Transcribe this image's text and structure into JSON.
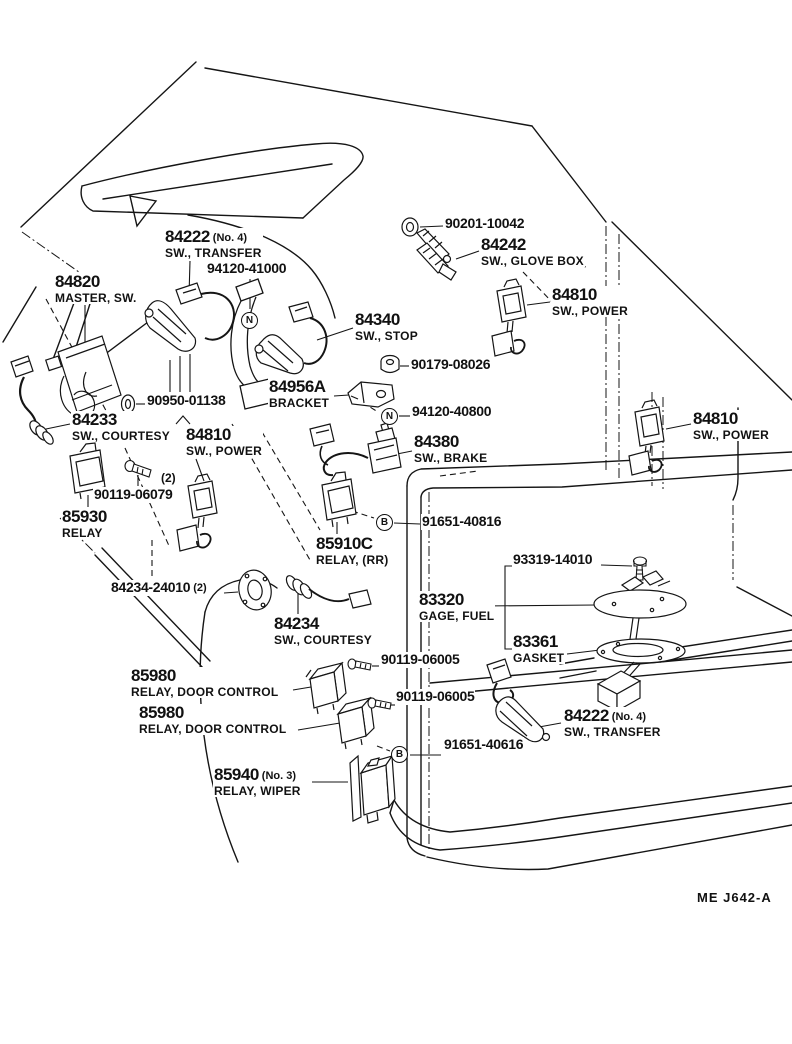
{
  "figure_code": "ME J642-A",
  "callouts": [
    {
      "num": "84222",
      "note": "(No. 4)",
      "desc": "SW., TRANSFER"
    },
    {
      "num": "94120-41000"
    },
    {
      "num": "90201-10042"
    },
    {
      "num": "84242",
      "desc": "SW., GLOVE BOX"
    },
    {
      "num": "84820",
      "desc": "MASTER, SW."
    },
    {
      "num": "84810",
      "desc": "SW., POWER"
    },
    {
      "num": "84340",
      "desc": "SW., STOP"
    },
    {
      "num": "90179-08026"
    },
    {
      "num": "84956A",
      "desc": "BRACKET"
    },
    {
      "num": "90950-01138"
    },
    {
      "num": "94120-40800"
    },
    {
      "num": "84233",
      "desc": "SW., COURTESY"
    },
    {
      "num": "84810",
      "desc": "SW., POWER"
    },
    {
      "num": "84810",
      "desc": "SW., POWER"
    },
    {
      "num": "84380",
      "desc": "SW., BRAKE"
    },
    {
      "note": "(2)"
    },
    {
      "num": "90119-06079"
    },
    {
      "num": "85930",
      "desc": "RELAY"
    },
    {
      "num": "91651-40816"
    },
    {
      "num": "85910C",
      "desc": "RELAY, (RR)"
    },
    {
      "num": "93319-14010"
    },
    {
      "num": "84234-24010",
      "note": "(2)"
    },
    {
      "num": "83320",
      "desc": "GAGE, FUEL"
    },
    {
      "num": "83361",
      "desc": "GASKET"
    },
    {
      "num": "84234",
      "desc": "SW., COURTESY"
    },
    {
      "num": "90119-06005"
    },
    {
      "num": "90119-06005"
    },
    {
      "num": "85980",
      "desc": "RELAY, DOOR CONTROL"
    },
    {
      "num": "85980",
      "desc": "RELAY, DOOR CONTROL"
    },
    {
      "num": "84222",
      "note": "(No. 4)",
      "desc": "SW., TRANSFER"
    },
    {
      "num": "91651-40616"
    },
    {
      "num": "85940",
      "note": "(No. 3)",
      "desc": "RELAY, WIPER"
    }
  ],
  "markers": [
    {
      "letter": "N"
    },
    {
      "letter": "N"
    },
    {
      "letter": "B"
    },
    {
      "letter": "B"
    }
  ]
}
